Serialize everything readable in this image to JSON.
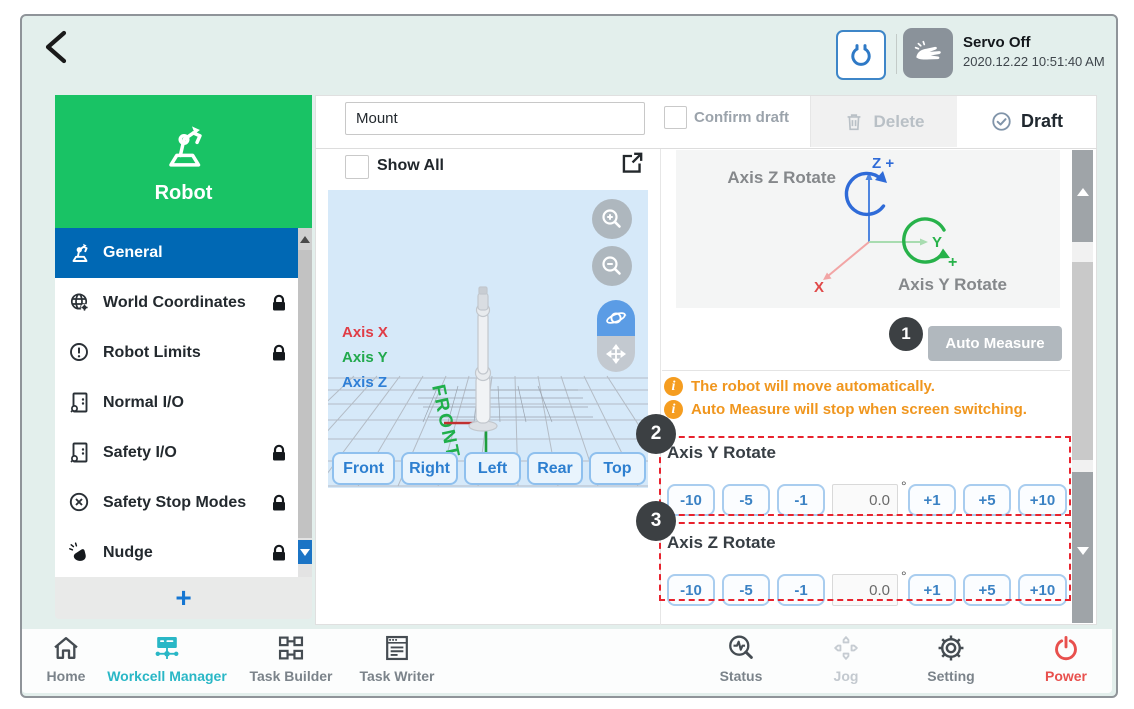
{
  "header": {
    "servo_status": "Servo Off",
    "datetime": "2020.12.22 10:51:40 AM"
  },
  "sidebar": {
    "title": "Robot",
    "items": [
      {
        "label": "General"
      },
      {
        "label": "World Coordinates"
      },
      {
        "label": "Robot Limits"
      },
      {
        "label": "Normal I/O"
      },
      {
        "label": "Safety I/O"
      },
      {
        "label": "Safety Stop Modes"
      },
      {
        "label": "Nudge"
      }
    ],
    "add_label": "+"
  },
  "toolbar": {
    "name_value": "Mount",
    "confirm_draft_label": "Confirm draft",
    "delete_label": "Delete",
    "draft_label": "Draft"
  },
  "viewer": {
    "show_all_label": "Show All",
    "axis_labels": {
      "x": "Axis X",
      "y": "Axis Y",
      "z": "Axis Z"
    },
    "floor_label": "FRONT",
    "view_buttons": [
      {
        "label": "Front"
      },
      {
        "label": "Right"
      },
      {
        "label": "Left"
      },
      {
        "label": "Rear"
      },
      {
        "label": "Top"
      }
    ]
  },
  "measure": {
    "diagram": {
      "axis_z_rotate": "Axis Z Rotate",
      "z_plus": "Z +",
      "y_label": "Y",
      "y_plus": "+",
      "x_label": "X",
      "axis_y_rotate": "Axis Y Rotate"
    },
    "auto_measure_label": "Auto Measure",
    "info_icon": "i",
    "notices": [
      {
        "text": "The robot will move automatically."
      },
      {
        "text": "Auto Measure will stop when screen switching."
      }
    ],
    "badges": [
      {
        "n": "1"
      },
      {
        "n": "2"
      },
      {
        "n": "3"
      }
    ],
    "sections": [
      {
        "label": "Axis Y Rotate",
        "minus": [
          "-10",
          "-5",
          "-1"
        ],
        "value": "0.0",
        "unit": "°",
        "plus": [
          "+1",
          "+5",
          "+10"
        ]
      },
      {
        "label": "Axis Z Rotate",
        "minus": [
          "-10",
          "-5",
          "-1"
        ],
        "value": "0.0",
        "unit": "°",
        "plus": [
          "+1",
          "+5",
          "+10"
        ]
      }
    ]
  },
  "nav": {
    "items": [
      {
        "label": "Home"
      },
      {
        "label": "Workcell Manager"
      },
      {
        "label": "Task Builder"
      },
      {
        "label": "Task Writer"
      },
      {
        "label": "Status"
      },
      {
        "label": "Jog"
      },
      {
        "label": "Setting"
      },
      {
        "label": "Power"
      }
    ]
  },
  "colors": {
    "green": "#19c365",
    "active_blue": "#0068b4",
    "nav_teal": "#29b7c6",
    "orange": "#f0961e",
    "annotation_red": "#e8232e",
    "power_red": "#e8504d",
    "button_blue": "#2d7fd0"
  }
}
